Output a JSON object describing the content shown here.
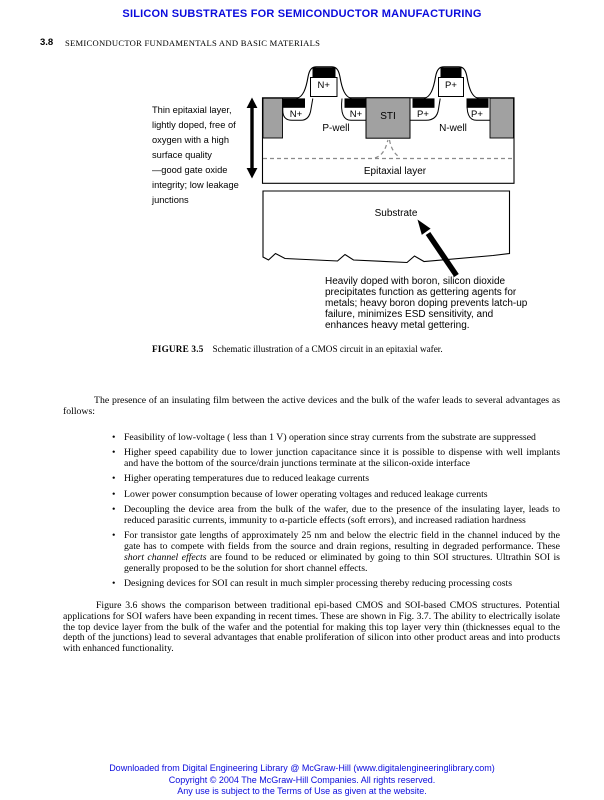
{
  "page": {
    "header_title": "SILICON SUBSTRATES FOR SEMICONDUCTOR MANUFACTURING",
    "page_number": "3.8",
    "running_head": "SEMICONDUCTOR FUNDAMENTALS AND BASIC MATERIALS"
  },
  "figure": {
    "left_note_lines": [
      "Thin epitaxial layer,",
      "lightly doped, free of",
      "oxygen with a high",
      "surface quality",
      "—good gate oxide",
      "integrity; low leakage",
      "junctions"
    ],
    "labels": {
      "gate_n": "N+",
      "gate_p": "P+",
      "nplus_left": "N+",
      "nplus_right": "N+",
      "pplus_left": "P+",
      "pplus_right": "P+",
      "sti": "STI",
      "pwell": "P-well",
      "nwell": "N-well",
      "epitaxial": "Epitaxial layer",
      "substrate": "Substrate"
    },
    "annotation_lines": [
      "Heavily doped with boron, silicon dioxide",
      "precipitates function as gettering agents for",
      "metals; heavy boron doping prevents latch-up",
      "failure, minimizes ESD sensitivity, and",
      "enhances heavy metal gettering."
    ],
    "caption_label": "FIGURE 3.5",
    "caption_text": "Schematic illustration of a CMOS circuit in an epitaxial wafer."
  },
  "body": {
    "bullet_char": "•",
    "para1": "The presence of an insulating film between the active devices and the bulk of the wafer leads to several advantages as follows:",
    "bullets": [
      {
        "text": "Feasibility of low-voltage ( less than 1 V) operation since stray currents from the substrate are suppressed"
      },
      {
        "text": "Higher speed capability due to lower junction capacitance since it is possible to dispense with well implants and have the bottom of the source/drain junctions terminate at the silicon-oxide interface"
      },
      {
        "text": "Higher operating temperatures due to reduced leakage currents"
      },
      {
        "text": "Lower power consumption because of lower operating voltages and reduced leakage currents"
      },
      {
        "text": "Decoupling the device area from the bulk of the wafer, due to the presence of the insulating layer, leads to reduced parasitic currents, immunity to α-particle effects (soft errors), and increased radiation hardness"
      },
      {
        "pre": "For transistor gate lengths of approximately 25 nm and below the electric field in the channel induced by the gate has to compete with fields from the source and drain regions, resulting in degraded performance. These ",
        "italic": "short channel effects",
        "post": " are found to be reduced or eliminated by going to thin SOI structures. Ultrathin SOI is generally proposed to be the solution for short channel effects."
      },
      {
        "text": "Designing devices for SOI can result in much simpler processing thereby reducing processing costs"
      }
    ],
    "para2": "Figure 3.6 shows the comparison between traditional epi-based CMOS and SOI-based CMOS structures. Potential applications for SOI wafers have been expanding in recent times. These are shown in Fig. 3.7. The ability to electrically isolate the top device layer from the bulk of the wafer and the potential for making this top layer very thin (thicknesses equal to the depth of the junctions) lead to several advantages that enable proliferation of silicon into other product areas and into products with enhanced functionality."
  },
  "footer": {
    "line1": "Downloaded from Digital Engineering Library @ McGraw-Hill (www.digitalengineeringlibrary.com)",
    "line2": "Copyright © 2004 The McGraw-Hill Companies. All rights reserved.",
    "line3": "Any use is subject to the Terms of Use as given at the website."
  },
  "colors": {
    "accent_blue": "#0b0bdd",
    "block_gray": "#a1a1a1",
    "dash_gray": "#8a8a8a"
  }
}
